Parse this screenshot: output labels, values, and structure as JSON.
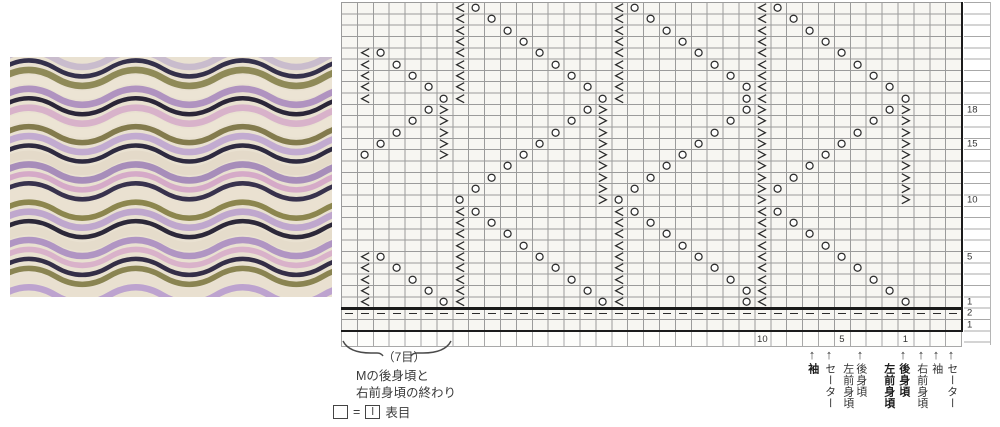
{
  "photo": {
    "description": "knitted-wave-swatch",
    "background": "#e9e1d1",
    "stripe_colors": [
      {
        "c": "#c9bccd",
        "w": 5
      },
      {
        "c": "#34304a",
        "w": 3
      },
      {
        "c": "#8f8a58",
        "w": 5
      },
      {
        "c": "#ece4d4",
        "w": 7
      },
      {
        "c": "#b093c0",
        "w": 5
      },
      {
        "c": "#2b2638",
        "w": 3
      },
      {
        "c": "#d8b2ca",
        "w": 5
      },
      {
        "c": "#ece4d4",
        "w": 7
      },
      {
        "c": "#837b4d",
        "w": 4
      },
      {
        "c": "#c2abd0",
        "w": 5
      },
      {
        "c": "#2e2a40",
        "w": 3
      },
      {
        "c": "#e4dac9",
        "w": 7
      },
      {
        "c": "#a78dba",
        "w": 5
      },
      {
        "c": "#d5aac8",
        "w": 4
      },
      {
        "c": "#38324d",
        "w": 3
      },
      {
        "c": "#eae1d1",
        "w": 7
      },
      {
        "c": "#8c864e",
        "w": 4
      },
      {
        "c": "#bfa7cd",
        "w": 5
      },
      {
        "c": "#2c2839",
        "w": 3
      },
      {
        "c": "#e5dccb",
        "w": 7
      },
      {
        "c": "#b095c3",
        "w": 5
      },
      {
        "c": "#d9b2ca",
        "w": 4
      },
      {
        "c": "#342e47",
        "w": 3
      },
      {
        "c": "#8a8452",
        "w": 4
      },
      {
        "c": "#e9e0d0",
        "w": 7
      },
      {
        "c": "#bda3cf",
        "w": 5
      }
    ]
  },
  "chart": {
    "columns": 39,
    "symbol_color": "#2b2b2b",
    "legend_symbols": {
      "o": "yarn-over",
      "l": "left-decrease",
      "r": "right-decrease",
      "d": "purl-dash"
    },
    "rows": [
      {
        "n": 27,
        "cells": [
          "8l",
          "9o",
          "18l",
          "19o",
          "27l",
          "28o"
        ]
      },
      {
        "n": 26,
        "cells": [
          "8l",
          "10o",
          "18l",
          "20o",
          "27l",
          "29o"
        ]
      },
      {
        "n": 25,
        "cells": [
          "8l",
          "11o",
          "18l",
          "21o",
          "27l",
          "30o"
        ]
      },
      {
        "n": 24,
        "cells": [
          "8l",
          "12o",
          "18l",
          "22o",
          "27l",
          "31o"
        ]
      },
      {
        "n": 23,
        "cells": [
          "2l",
          "3o",
          "8l",
          "13o",
          "18l",
          "23o",
          "27l",
          "32o"
        ]
      },
      {
        "n": 22,
        "cells": [
          "2l",
          "4o",
          "8l",
          "14o",
          "18l",
          "24o",
          "27l",
          "33o"
        ]
      },
      {
        "n": 21,
        "cells": [
          "2l",
          "5o",
          "8l",
          "15o",
          "18l",
          "25o",
          "27l",
          "34o"
        ]
      },
      {
        "n": 20,
        "cells": [
          "2l",
          "6o",
          "8l",
          "16o",
          "18l",
          "26o",
          "27l",
          "35o"
        ]
      },
      {
        "n": 19,
        "cells": [
          "2l",
          "7o",
          "8l",
          "17o",
          "18l",
          "26o",
          "27l",
          "36o"
        ]
      },
      {
        "n": 18,
        "label": "18",
        "cells": [
          "6o",
          "7r",
          "16o",
          "17r",
          "26o",
          "27r",
          "35o",
          "36r"
        ]
      },
      {
        "n": 17,
        "cells": [
          "5o",
          "7r",
          "15o",
          "17r",
          "25o",
          "27r",
          "34o",
          "36r"
        ]
      },
      {
        "n": 16,
        "cells": [
          "4o",
          "7r",
          "14o",
          "17r",
          "24o",
          "27r",
          "33o",
          "36r"
        ]
      },
      {
        "n": 15,
        "label": "15",
        "cells": [
          "3o",
          "7r",
          "13o",
          "17r",
          "23o",
          "27r",
          "32o",
          "36r"
        ]
      },
      {
        "n": 14,
        "cells": [
          "2o",
          "7r",
          "12o",
          "17r",
          "22o",
          "27r",
          "31o",
          "36r"
        ]
      },
      {
        "n": 13,
        "cells": [
          "11o",
          "17r",
          "21o",
          "27r",
          "30o",
          "36r"
        ]
      },
      {
        "n": 12,
        "cells": [
          "10o",
          "17r",
          "20o",
          "27r",
          "29o",
          "36r"
        ]
      },
      {
        "n": 11,
        "cells": [
          "9o",
          "17r",
          "19o",
          "27r",
          "28o",
          "36r"
        ]
      },
      {
        "n": 10,
        "label": "10",
        "cells": [
          "8o",
          "17r",
          "18o",
          "27r",
          "36r"
        ]
      },
      {
        "n": 9,
        "cells": [
          "8l",
          "9o",
          "18l",
          "19o",
          "27l",
          "28o"
        ]
      },
      {
        "n": 8,
        "cells": [
          "8l",
          "10o",
          "18l",
          "20o",
          "27l",
          "29o"
        ]
      },
      {
        "n": 7,
        "cells": [
          "8l",
          "11o",
          "18l",
          "21o",
          "27l",
          "30o"
        ]
      },
      {
        "n": 6,
        "cells": [
          "8l",
          "12o",
          "18l",
          "22o",
          "27l",
          "31o"
        ]
      },
      {
        "n": 5,
        "label": "5",
        "cells": [
          "2l",
          "3o",
          "8l",
          "13o",
          "18l",
          "23o",
          "27l",
          "32o"
        ]
      },
      {
        "n": 4,
        "cells": [
          "2l",
          "4o",
          "8l",
          "14o",
          "18l",
          "24o",
          "27l",
          "33o"
        ]
      },
      {
        "n": 3,
        "cells": [
          "2l",
          "5o",
          "8l",
          "15o",
          "18l",
          "25o",
          "27l",
          "34o"
        ]
      },
      {
        "n": 2,
        "cells": [
          "2l",
          "6o",
          "8l",
          "16o",
          "18l",
          "26o",
          "27l",
          "35o"
        ]
      },
      {
        "n": 1,
        "label": "1",
        "cells": [
          "2l",
          "7o",
          "8l",
          "17o",
          "18l",
          "26o",
          "27l",
          "36o"
        ]
      },
      {
        "n": "p2",
        "label": "2",
        "dash": true
      },
      {
        "n": "p1",
        "label": "1",
        "cells": []
      }
    ],
    "column_numbers": [
      {
        "col": 27,
        "text": "10"
      },
      {
        "col": 32,
        "text": "5"
      },
      {
        "col": 36,
        "text": "1"
      }
    ]
  },
  "annotations": {
    "brace_label": "（7目）",
    "note_line1": "Mの後身頃と",
    "note_line2": "右前身頃の終わり",
    "legend": {
      "equals": "=",
      "label": "表目"
    }
  },
  "piece_markers": [
    {
      "x": 812,
      "label": "袖",
      "bold": true,
      "arrow": true
    },
    {
      "x": 829,
      "label": "セーター",
      "bold": false,
      "arrow": true
    },
    {
      "x": 847,
      "label": "左前身頃",
      "bold": false,
      "arrow": false
    },
    {
      "x": 860,
      "label": "後身頃",
      "bold": false,
      "arrow": true
    },
    {
      "x": 888,
      "label": "左前身頃",
      "bold": true,
      "arrow": false
    },
    {
      "x": 903,
      "label": "後身頃",
      "bold": true,
      "arrow": true
    },
    {
      "x": 921,
      "label": "右前身頃",
      "bold": false,
      "arrow": true
    },
    {
      "x": 936,
      "label": "袖",
      "bold": false,
      "arrow": true
    },
    {
      "x": 951,
      "label": "セーター",
      "bold": false,
      "arrow": true
    }
  ],
  "arrow_icon": "↑"
}
